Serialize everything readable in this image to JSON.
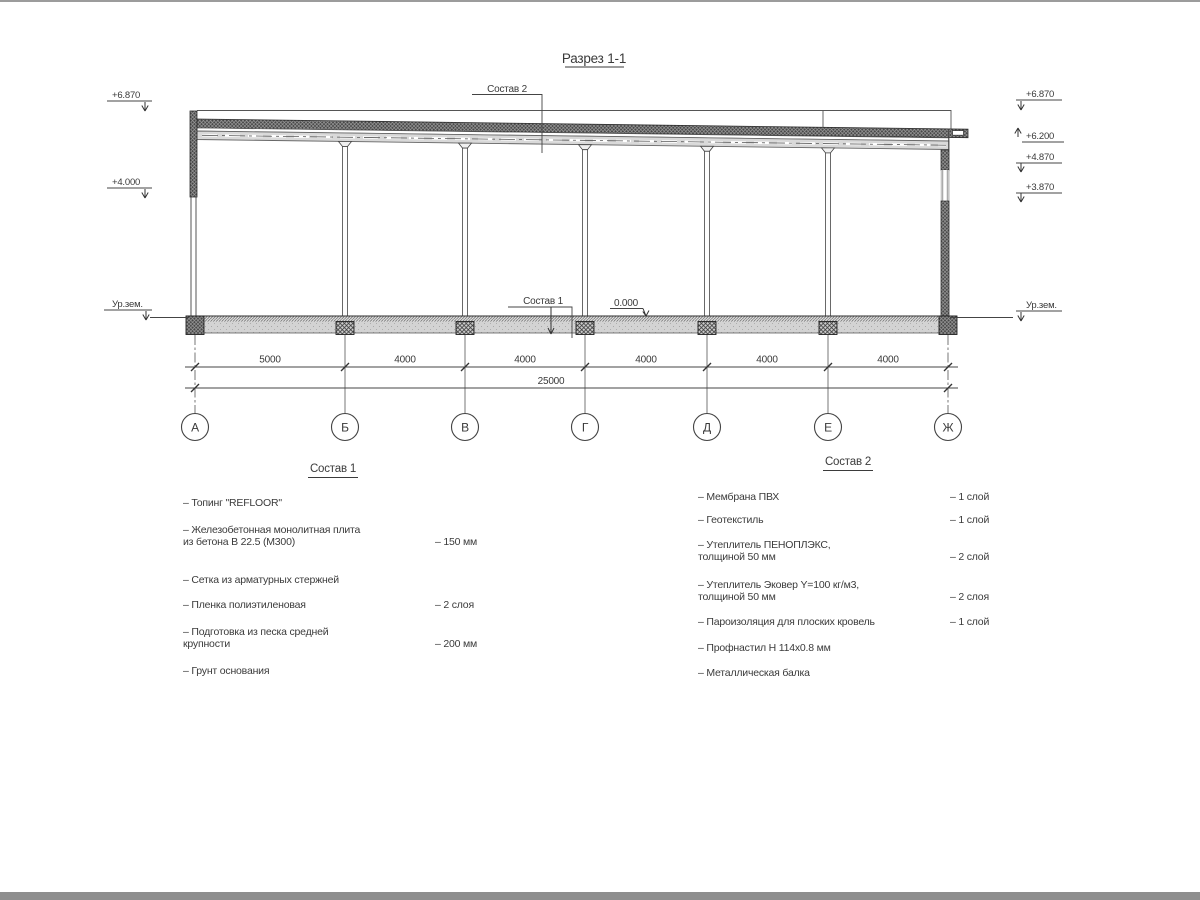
{
  "title": "Разрез 1-1",
  "callouts": {
    "sostav2": "Состав 2",
    "sostav1": "Состав 1",
    "zero": "0.000"
  },
  "elevations": {
    "left": [
      "+6.870",
      "+4.000",
      "Ур.зем."
    ],
    "right": [
      "+6.870",
      "+6.200",
      "+4.870",
      "+3.870",
      "Ур.зем."
    ]
  },
  "dimensions": {
    "bays": [
      "5000",
      "4000",
      "4000",
      "4000",
      "4000",
      "4000"
    ],
    "total": "25000"
  },
  "axes": [
    "А",
    "Б",
    "В",
    "Г",
    "Д",
    "Е",
    "Ж"
  ],
  "sostav1": {
    "title": "Состав 1",
    "items": [
      {
        "text": "– Топинг \"REFLOOR\"",
        "value": ""
      },
      {
        "text": "– Железобетонная  монолитная плита\nиз бетона В 22.5 (М300)",
        "value": "– 150 мм"
      },
      {
        "text": "– Сетка из арматурных стержней",
        "value": ""
      },
      {
        "text": "– Пленка полиэтиленовая",
        "value": "–  2 слоя"
      },
      {
        "text": "– Подготовка из песка средней\nкрупности",
        "value": "– 200 мм"
      },
      {
        "text": "– Грунт основания",
        "value": ""
      }
    ]
  },
  "sostav2": {
    "title": "Состав 2",
    "items": [
      {
        "text": "– Мембрана ПВХ",
        "value": "– 1 слой"
      },
      {
        "text": "– Геотекстиль",
        "value": "– 1 слой"
      },
      {
        "text": "– Утеплитель ПЕНОПЛЭКС,\nтолщиной 50 мм",
        "value": "– 2 слой"
      },
      {
        "text": "– Утеплитель Эковер Y=100 кг/м3,\nтолщиной 50 мм",
        "value": "– 2 слоя"
      },
      {
        "text": "– Пароизоляция для плоских кровель",
        "value": "– 1 слой"
      },
      {
        "text": "– Профнастил Н 114х0.8 мм",
        "value": ""
      },
      {
        "text": "– Металлическая балка",
        "value": ""
      }
    ]
  }
}
